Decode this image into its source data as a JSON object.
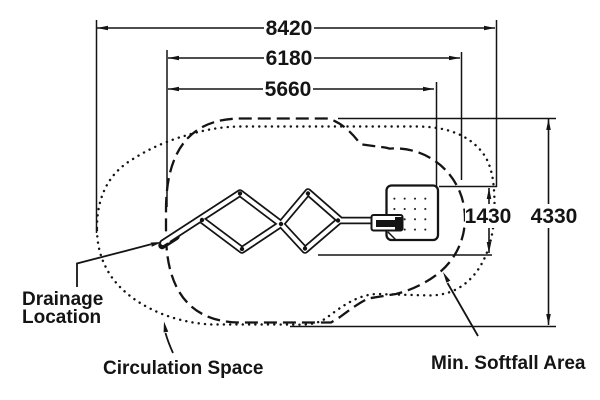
{
  "diagram": {
    "description": "Plan-view playground equipment dimension drawing",
    "dimensions": {
      "overall_width": "8420",
      "softfall_width": "6180",
      "equipment_width": "5660",
      "equipment_depth": "1430",
      "softfall_depth": "4330"
    },
    "labels": {
      "drainage_line1": "Drainage",
      "drainage_line2": "Location",
      "circulation_space": "Circulation Space",
      "min_softfall_area": "Min. Softfall Area"
    },
    "colors": {
      "ink": "#141414",
      "background": "#ffffff"
    }
  }
}
